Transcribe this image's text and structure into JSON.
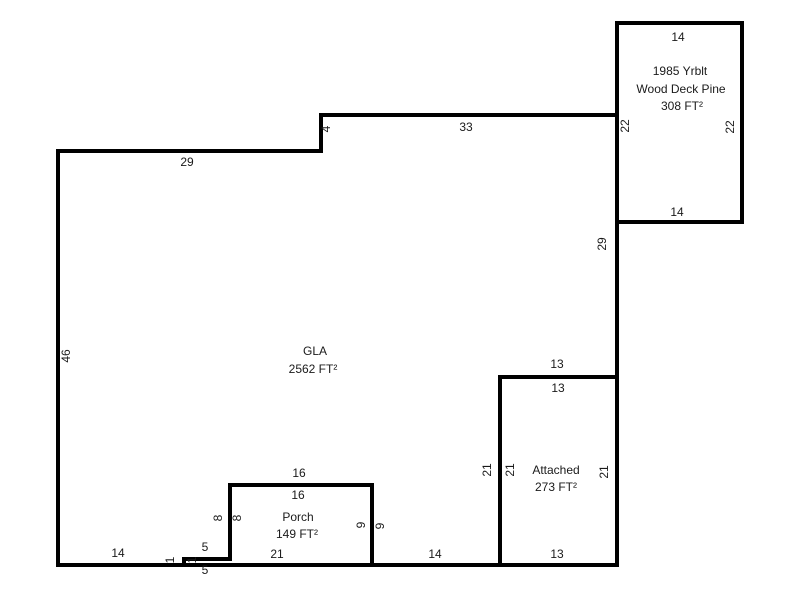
{
  "areas": {
    "gla": {
      "name": "GLA",
      "area": "2562 FT²"
    },
    "porch": {
      "name": "Porch",
      "area": "149 FT²"
    },
    "attached": {
      "name": "Attached",
      "area": "273 FT²"
    },
    "deck": {
      "yrblt": "1985 Yrblt",
      "name": "Wood Deck Pine",
      "area": "308 FT²"
    }
  },
  "dims": {
    "deck_top": "14",
    "deck_left": "22",
    "deck_right": "22",
    "deck_bottom": "14",
    "gla_top_left": "29",
    "gla_step": "4",
    "gla_top_right": "33",
    "gla_right_upper": "29",
    "gla_left": "46",
    "gla_bottom_left": "14",
    "gla_bottom_mid": "14",
    "att_top_outer": "13",
    "att_top_inner": "13",
    "att_left_outer": "21",
    "att_left_inner": "21",
    "att_right": "21",
    "att_bottom": "13",
    "porch_top_outer": "16",
    "porch_top_inner": "16",
    "porch_left_outer": "8",
    "porch_left_inner": "8",
    "porch_right_inner": "9",
    "porch_right_outer": "9",
    "porch_bottom": "21",
    "jog_top": "5",
    "jog_bottom": "5",
    "jog_left": "1",
    "jog_right": "1"
  },
  "colors": {
    "line": "#000000",
    "text": "#1a1a1a",
    "background": "#ffffff"
  }
}
